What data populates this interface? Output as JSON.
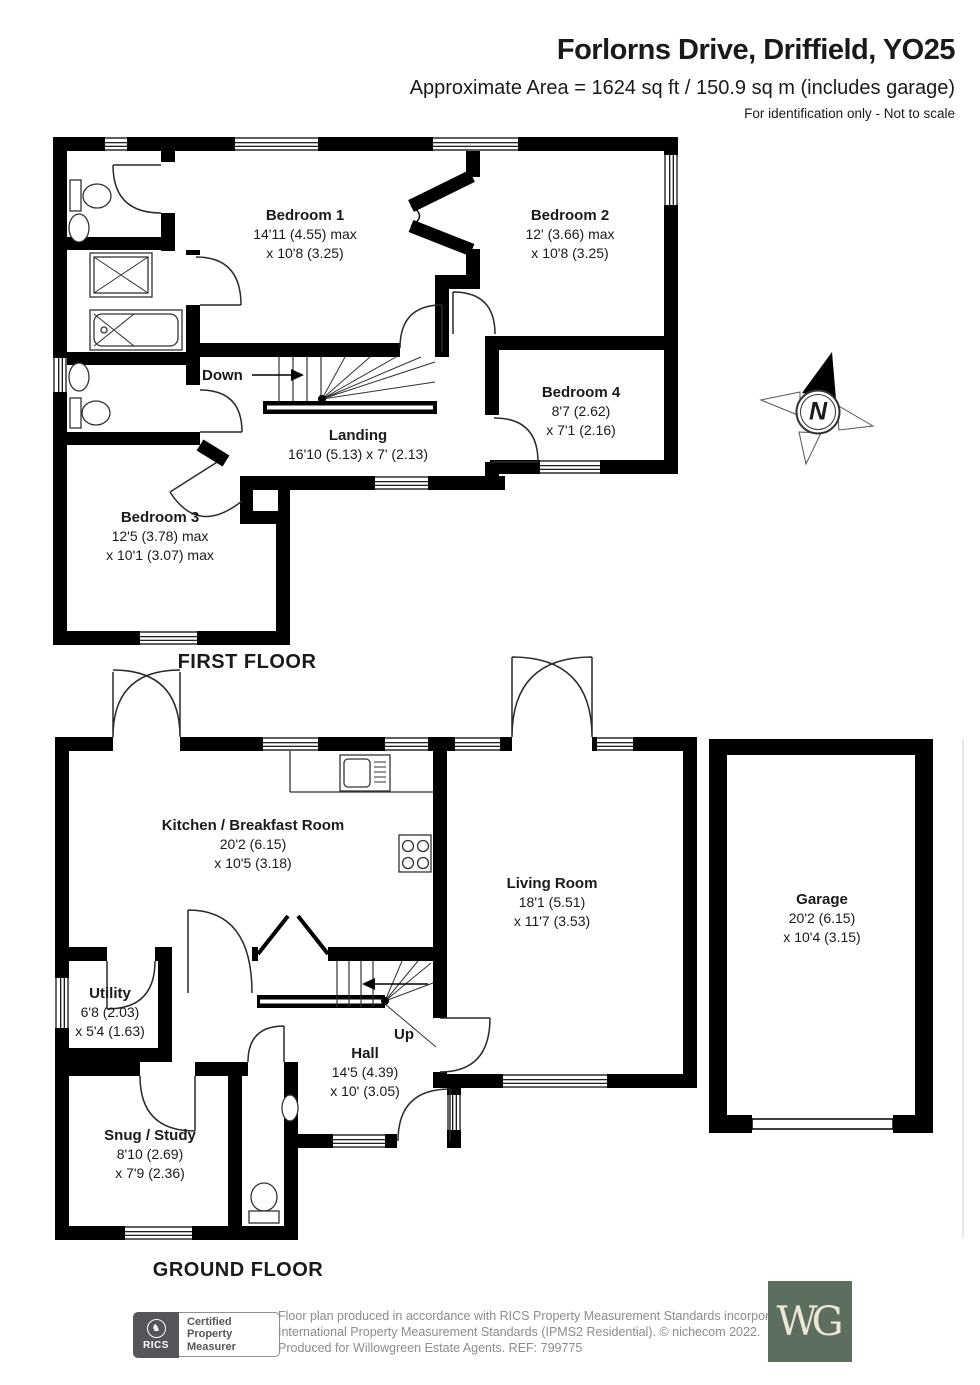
{
  "header": {
    "title": "Forlorns Drive, Driffield, YO25",
    "subtitle": "Approximate Area = 1624 sq ft / 150.9 sq m (includes garage)",
    "note": "For identification only - Not to scale"
  },
  "compass": {
    "label": "N"
  },
  "floors": {
    "first": {
      "label": "FIRST FLOOR",
      "stair": "Down",
      "rooms": {
        "bedroom1": {
          "name": "Bedroom 1",
          "l1": "14'11 (4.55) max",
          "l2": "x 10'8 (3.25)"
        },
        "bedroom2": {
          "name": "Bedroom 2",
          "l1": "12' (3.66) max",
          "l2": "x 10'8 (3.25)"
        },
        "bedroom4": {
          "name": "Bedroom 4",
          "l1": "8'7 (2.62)",
          "l2": "x 7'1 (2.16)"
        },
        "landing": {
          "name": "Landing",
          "l1": "16'10 (5.13) x 7' (2.13)"
        },
        "bedroom3": {
          "name": "Bedroom 3",
          "l1": "12'5 (3.78) max",
          "l2": "x 10'1 (3.07) max"
        }
      }
    },
    "ground": {
      "label": "GROUND FLOOR",
      "stair": "Up",
      "rooms": {
        "kitchen": {
          "name": "Kitchen / Breakfast Room",
          "l1": "20'2 (6.15)",
          "l2": "x 10'5 (3.18)"
        },
        "living": {
          "name": "Living Room",
          "l1": "18'1 (5.51)",
          "l2": "x 11'7 (3.53)"
        },
        "utility": {
          "name": "Utility",
          "l1": "6'8 (2.03)",
          "l2": "x 5'4 (1.63)"
        },
        "snug": {
          "name": "Snug / Study",
          "l1": "8'10 (2.69)",
          "l2": "x 7'9 (2.36)"
        },
        "hall": {
          "name": "Hall",
          "l1": "14'5 (4.39)",
          "l2": "x 10' (3.05)"
        },
        "garage": {
          "name": "Garage",
          "l1": "20'2 (6.15)",
          "l2": "x 10'4 (3.15)"
        }
      }
    }
  },
  "footer": {
    "rics": {
      "brand": "RICS",
      "crest": "♞",
      "cert_line1": "Certified",
      "cert_line2": "Property",
      "cert_line3": "Measurer"
    },
    "line1": "Floor plan produced in accordance with RICS Property Measurement Standards incorporating",
    "line2": "International Property Measurement Standards (IPMS2 Residential).   © nichecom 2022.",
    "line3": "Produced for Willowgreen Estate Agents.    REF:  799775",
    "logo_text": "WG"
  },
  "colors": {
    "wall": "#000000",
    "logo_green": "#5c6e5e",
    "footer_grey": "#8c8c8c"
  }
}
